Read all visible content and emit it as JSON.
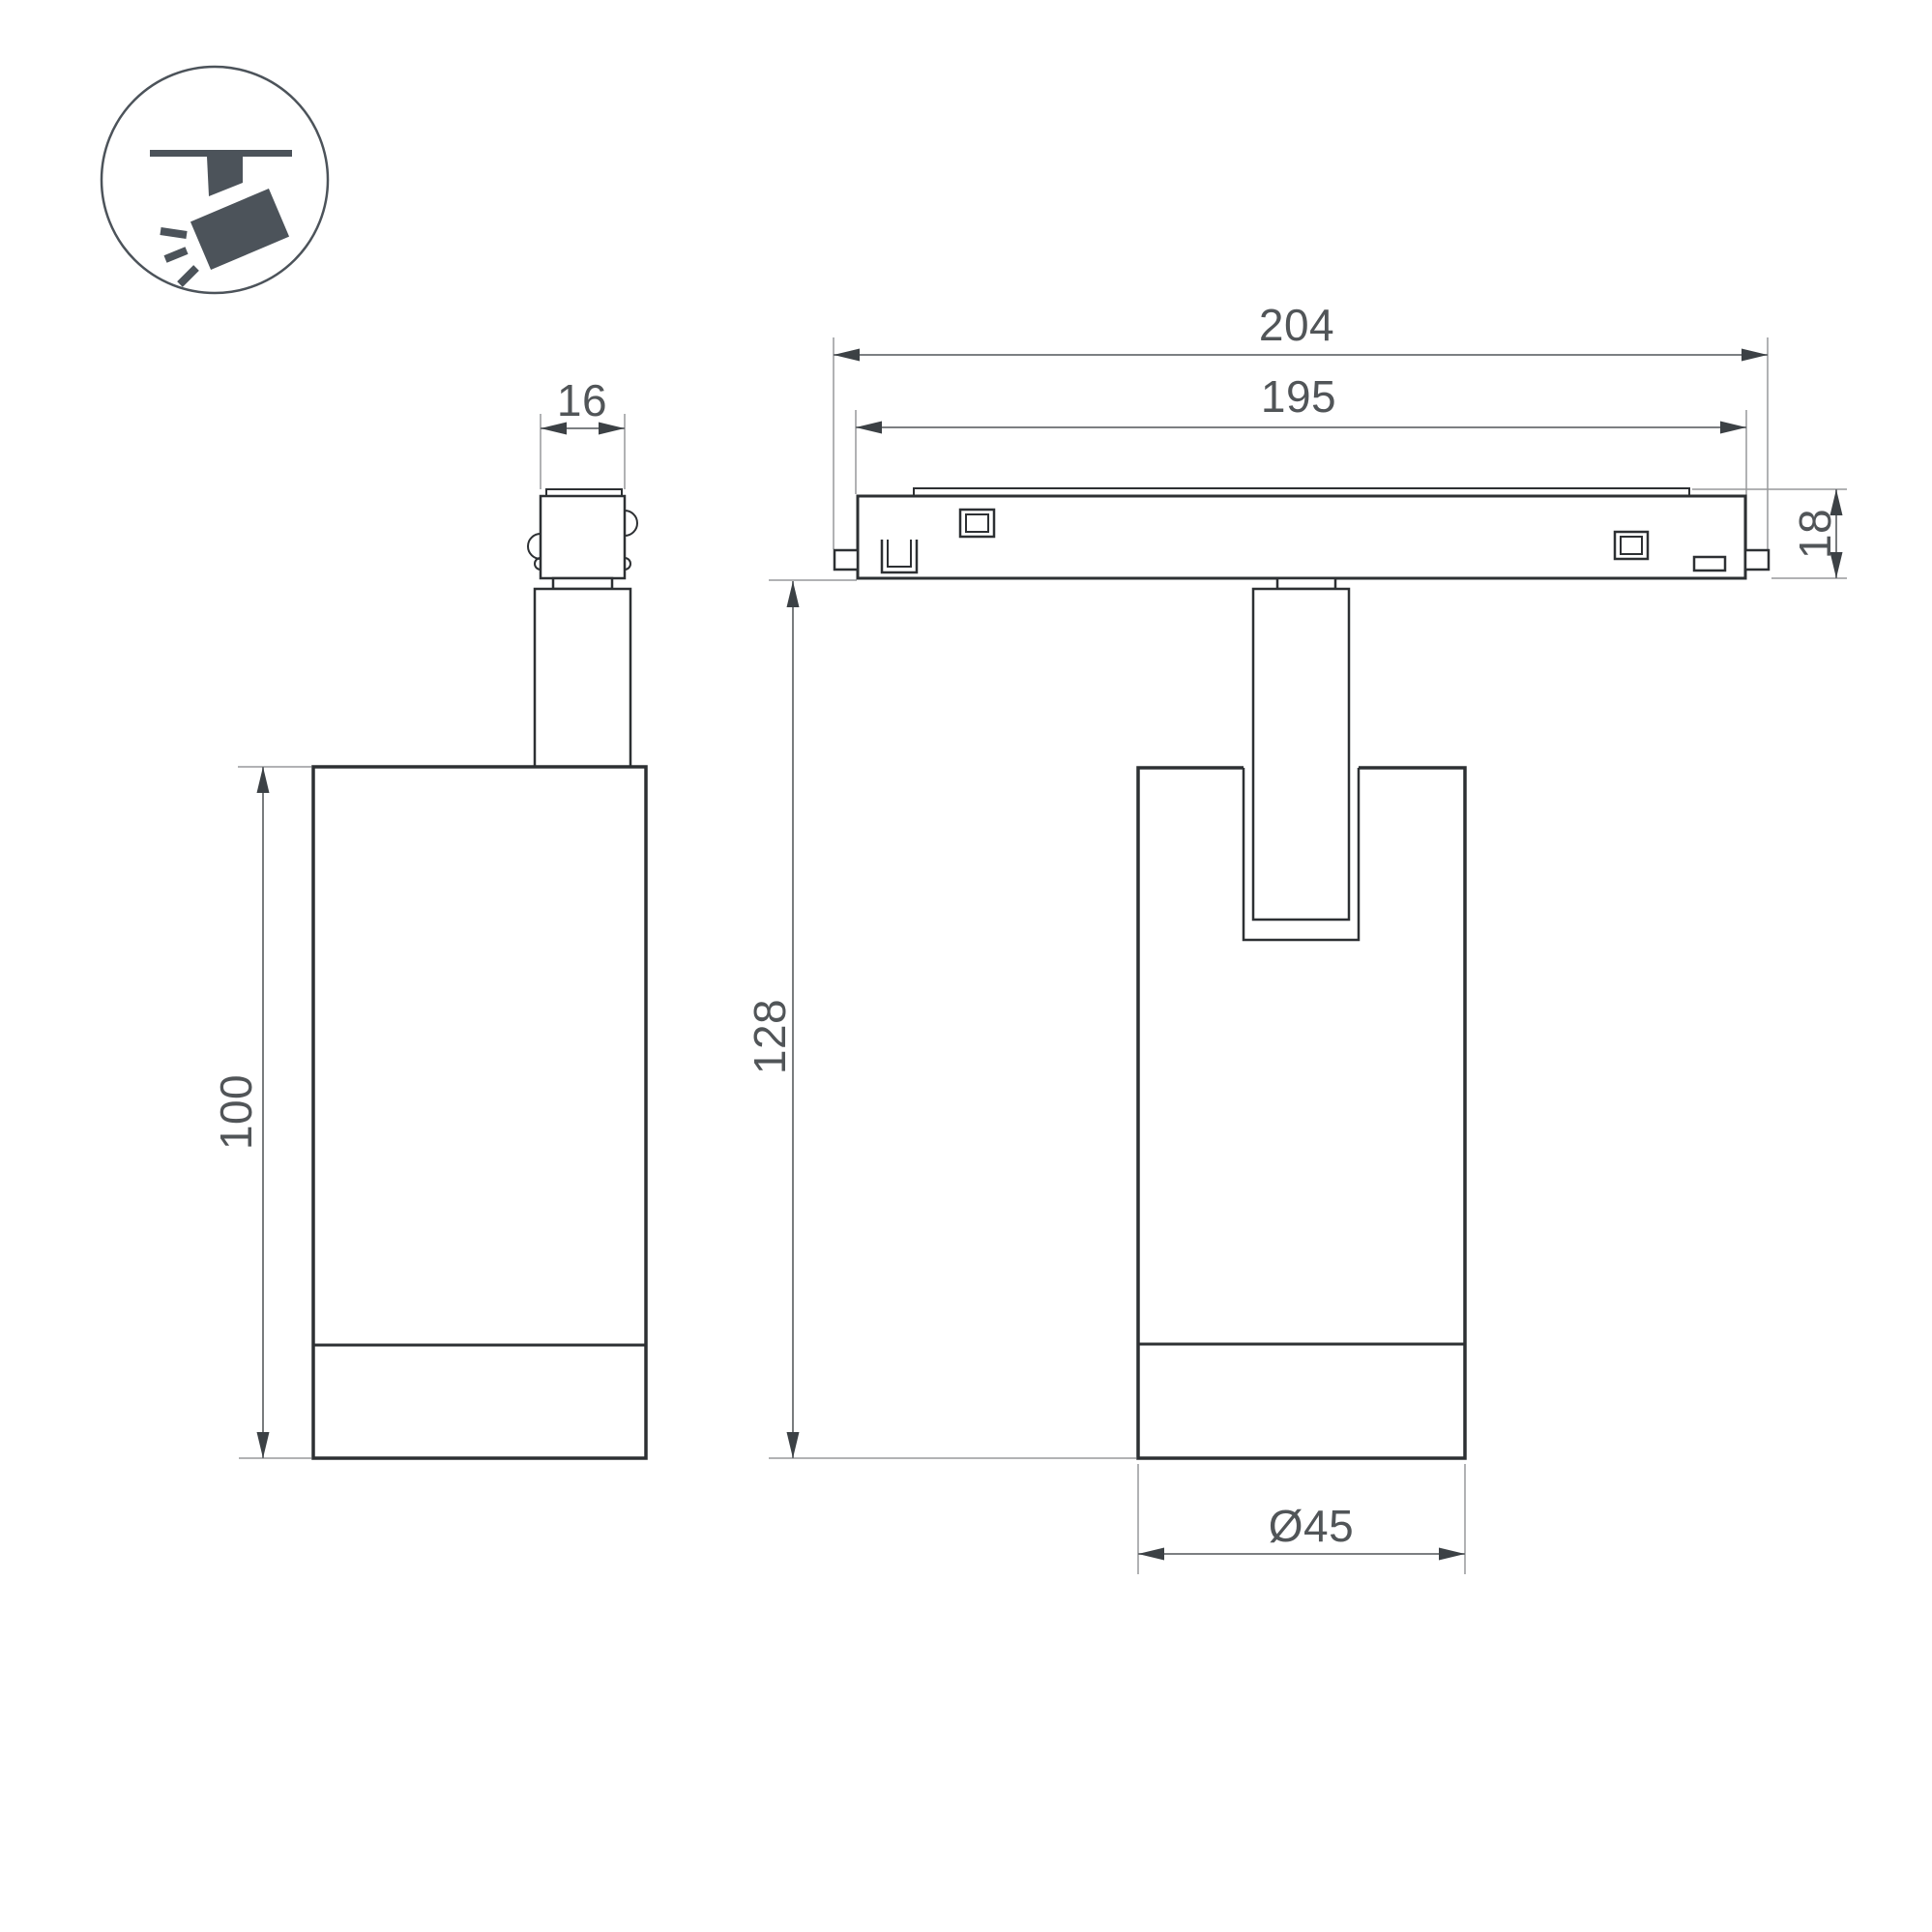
{
  "colors": {
    "background": "#ffffff",
    "outline": "#2d3033",
    "dimension_line": "#6a6d70",
    "extension_line": "#97999b",
    "arrowhead": "#3c4145",
    "dimension_text": "#515558",
    "icon": "#4c535a"
  },
  "icon_badge": {
    "icon": "ceiling-track-spotlight-icon"
  },
  "side_view": {
    "dimensions": {
      "adapter_width": "16",
      "body_height": "100"
    }
  },
  "front_view": {
    "dimensions": {
      "total_length": "204",
      "track_length": "195",
      "track_height": "18",
      "overall_height": "128",
      "body_diameter": "Ø45"
    }
  }
}
